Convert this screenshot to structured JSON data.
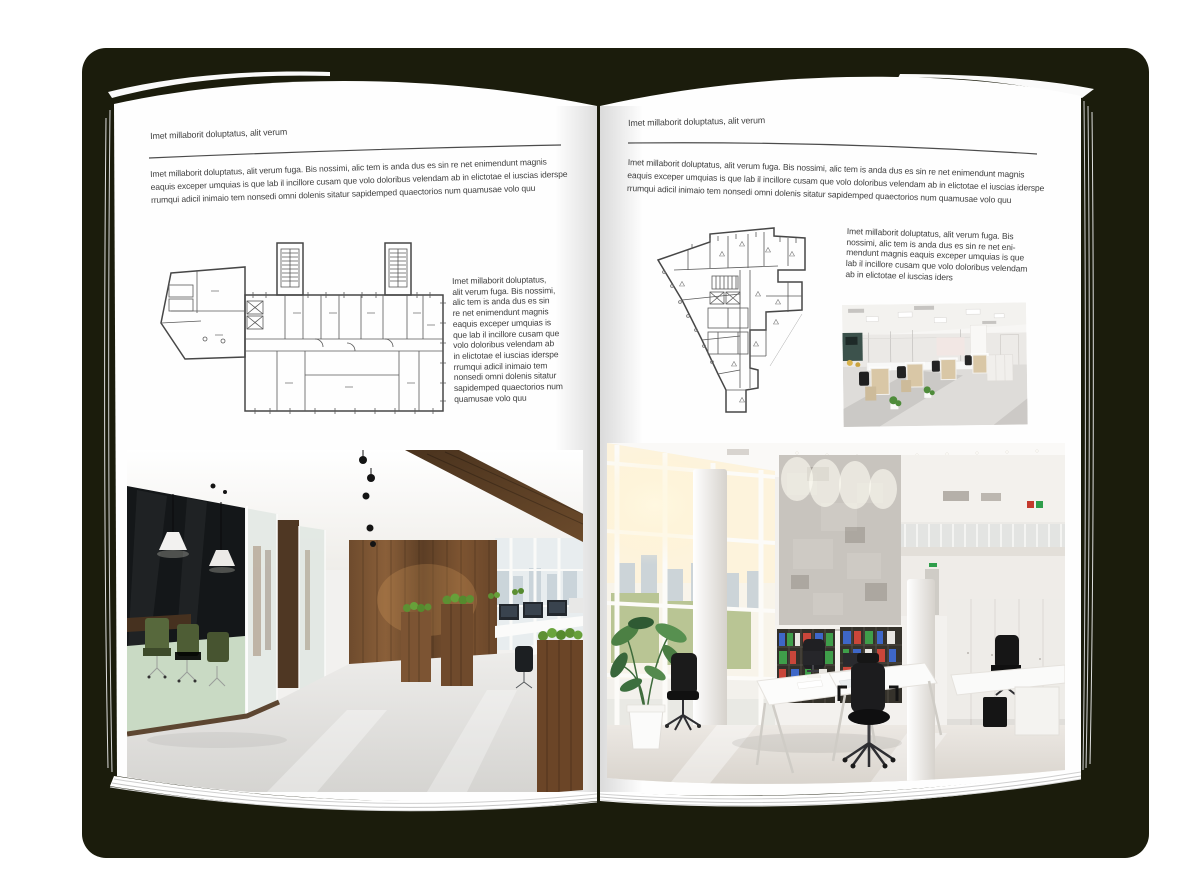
{
  "mockup": {
    "description": "open brochure spread mockup",
    "shadow_color": "#1b1c0c"
  },
  "left_page": {
    "header": "Imet millaborit doluptatus, alit verum",
    "intro_lines": [
      "Imet millaborit doluptatus, alit verum fuga. Bis nossimi, alic tem is anda dus es sin re net enimendunt magnis",
      "eaquis exceper umquias is que lab il incillore cusam que volo doloribus velendam ab in elictotae el iuscias iderspe",
      "rrumqui adicil inimaio tem nonsedi omni dolenis sitatur sapidemped quaectorios num quamusae volo quu"
    ],
    "side_lines": [
      "Imet millaborit doluptatus,",
      "alit verum fuga. Bis nossimi,",
      "alic tem is anda dus es sin",
      "re net enimendunt magnis",
      "eaquis exceper umquias is",
      "que lab il incillore cusam que",
      "volo doloribus velendam ab",
      "in elictotae el iuscias iderspe",
      "rrumqui adicil inimaio tem",
      "nonsedi omni dolenis sitatur",
      "sapidemped quaectorios num",
      "quamusae volo quu"
    ],
    "floorplan_name": "wide building floor plan",
    "photo_name": "dark wood and glass office interior"
  },
  "right_page": {
    "header": "Imet millaborit doluptatus, alit verum",
    "intro_lines": [
      "Imet millaborit doluptatus, alit verum fuga. Bis nossimi, alic tem is anda dus es sin re net enimendunt magnis",
      "eaquis exceper umquias is que lab il incillore cusam que volo doloribus velendam ab in elictotae el iuscias iderspe",
      "rrumqui adicil inimaio tem nonsedi omni dolenis sitatur sapidemped quaectorios num quamusae volo quu"
    ],
    "side_lines": [
      "Imet millaborit doluptatus, alit verum fuga. Bis",
      "nossimi, alic tem is anda dus es sin re net eni-",
      "mendunt magnis eaquis exceper umquias is que",
      "lab il incillore cusam que volo doloribus velendam",
      "ab in elictotae el iuscias iders"
    ],
    "floorplan_name": "irregular building floor plan",
    "photo_small_name": "open plan cubicle office",
    "photo_large_name": "white atrium office interior"
  }
}
